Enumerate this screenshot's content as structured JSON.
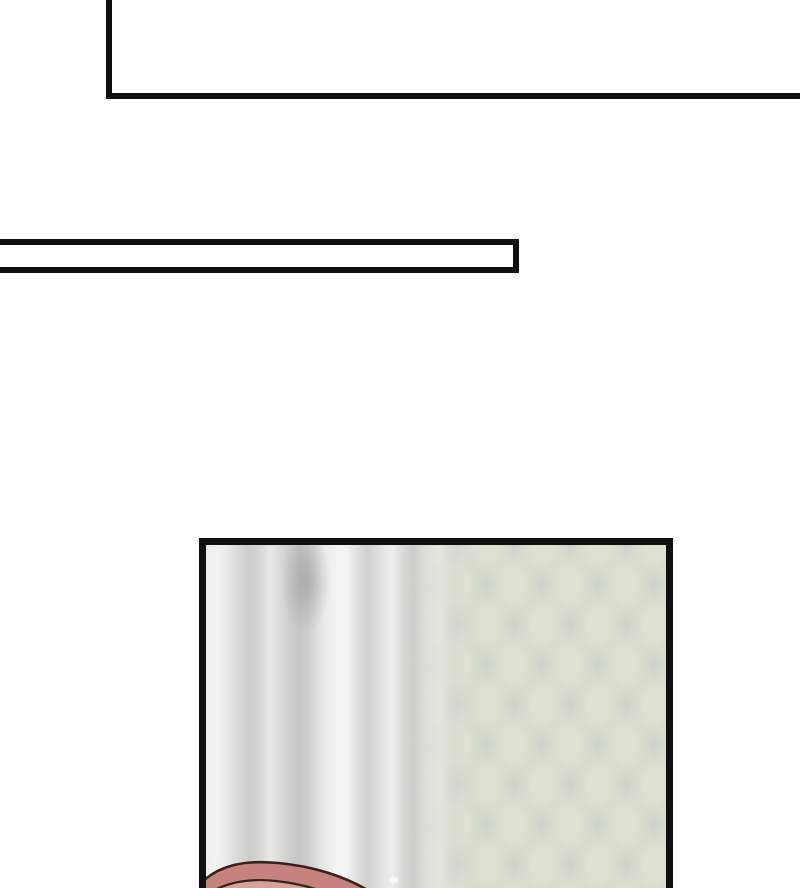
{
  "page": {
    "type": "comic-page-fragment",
    "background": "#ffffff",
    "panels": [
      {
        "id": "top-panel",
        "description": "empty white panel cropped by the top and right edges of the page",
        "fill": "#fefefe"
      },
      {
        "id": "narrow-strip-panel",
        "description": "thin empty white rectangle cropped by the left edge of the page",
        "fill": "#fefefe"
      },
      {
        "id": "main-panel",
        "description": "blurred interior scene: white-gray curtain folds on the left, pale sage diamond-quilted wallpaper on the right, top of a pink-haired head entering from the bottom edge",
        "elements": [
          "blurred-curtain",
          "diamond-wallpaper",
          "pink-hair-arc",
          "small-highlight-dot"
        ]
      }
    ]
  },
  "colors": {
    "paper": "#ffffff",
    "ink": "#101010",
    "panel_fill": "#fefefe",
    "curtain_light": "#f4f4f2",
    "curtain_mid": "#dededa",
    "curtain_dark": "#c6c6c2",
    "curtain_shadow_blob": "#92928e",
    "wallpaper_base": "#c9d1c9",
    "wallpaper_light": "#dde1d1",
    "hair_fill": "#c6837d",
    "hair_light": "#d7a29a",
    "hair_outline": "#38211e",
    "highlight_dot": "#fbfbf9"
  }
}
